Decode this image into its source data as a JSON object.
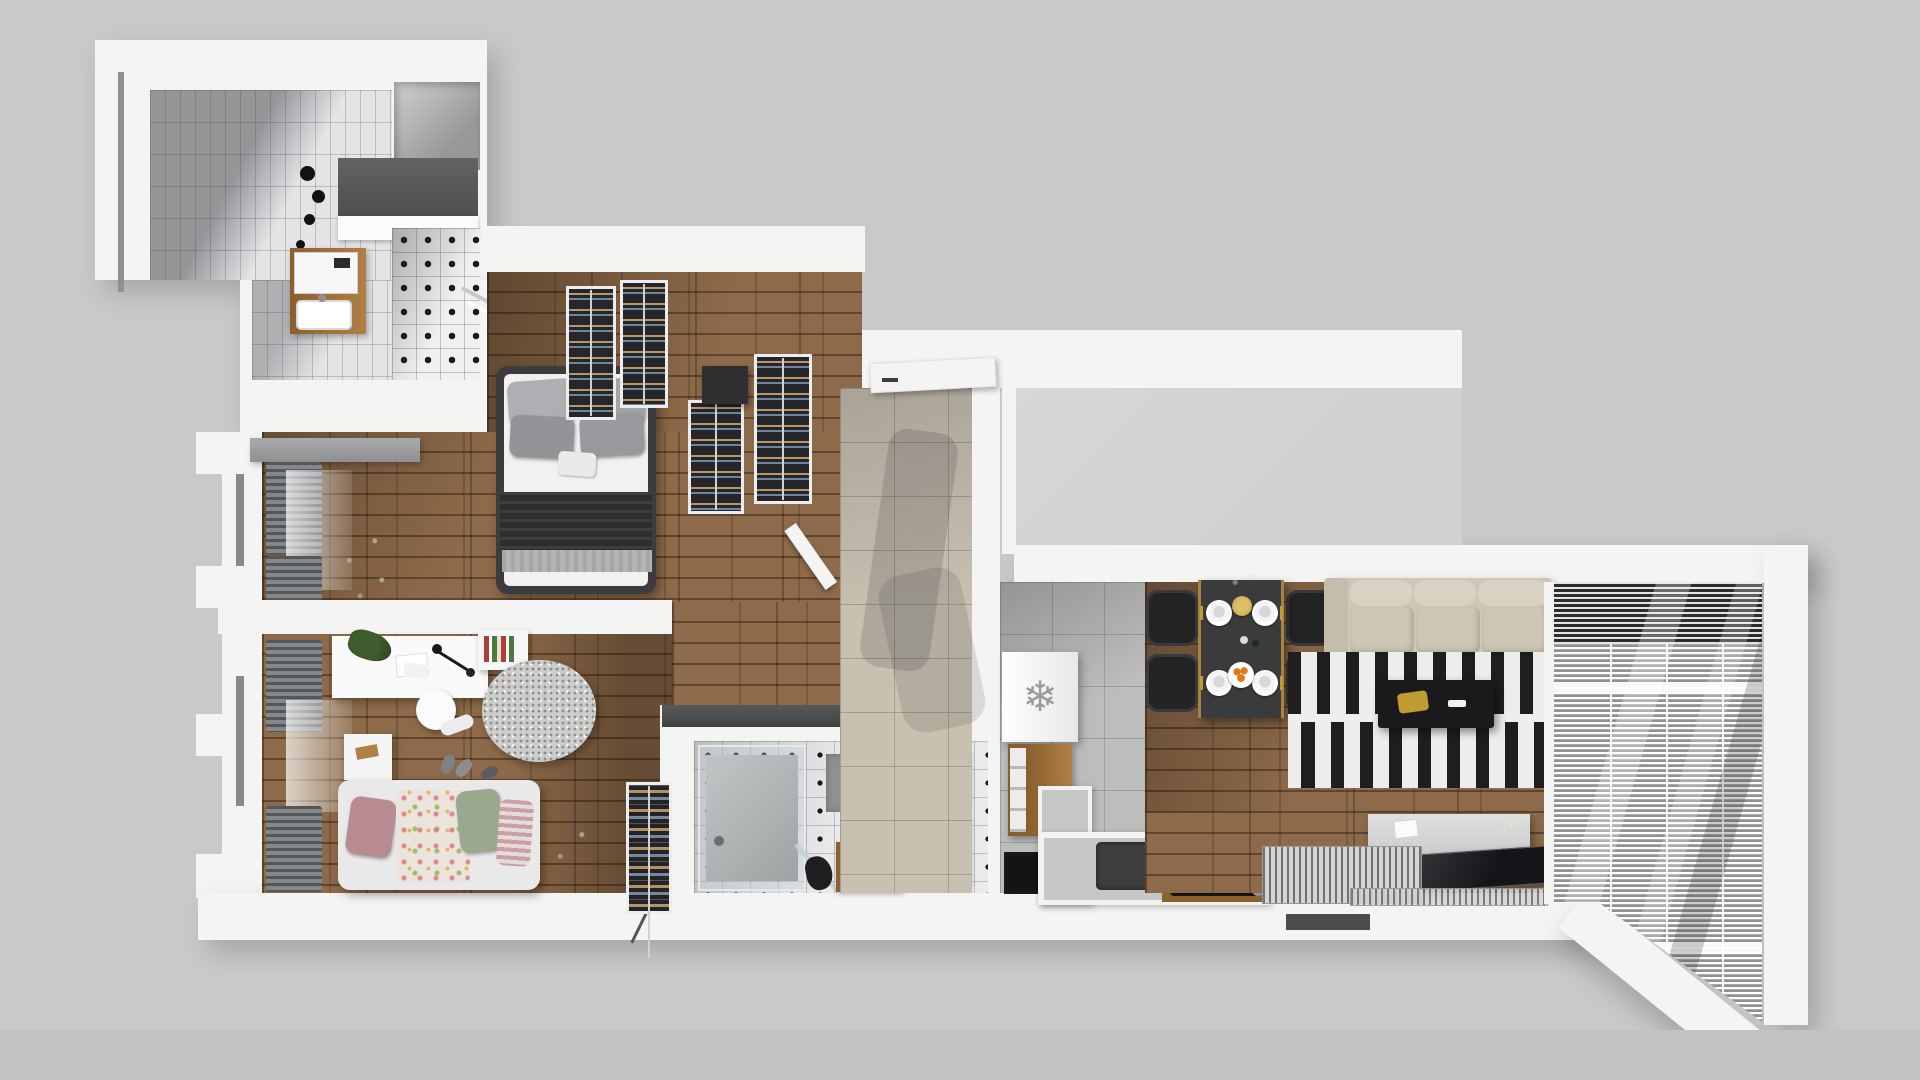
{
  "scene": {
    "kind": "apartment-floor-plan-3d-render",
    "view": "top-down"
  },
  "colors": {
    "bg": "#c9c9ca",
    "bg_bottom": "#c2c2c3",
    "wall": "#f4f4f2",
    "wall_block": "#d0d1d3",
    "wood_base": "#7a5a3c",
    "wood_row": "#8d6a49",
    "wood_gap": "#5f452e",
    "tile_beige": "#c8c1b2",
    "tile_gray": "#bdbdbe",
    "tile_bath": "#eaeaec",
    "accent_black": "#17181a",
    "rug_stripe": "#1e1e20",
    "sofa": "#cec7b6",
    "sofa_back": "#d9d2c2",
    "sofa_arm": "#c4bdac",
    "curtain": "#54565a",
    "plant": "#33502a",
    "plant_light": "#5d7f45",
    "wood_furn": "#b08046",
    "wood_furn_dark": "#8a5f2e",
    "balcony_dark": "#2d2d2f",
    "counter_gray": "#c5c7c7",
    "hob_black": "#141416",
    "freezer_icon_color": "#9b9b9d",
    "kid_pink": "#b88a92",
    "kid_green": "#9aa88e",
    "kid_stripe": "#c9a0a4",
    "gold": "#c09a33",
    "orange": "#e07818"
  },
  "icons": {
    "freezer_snowflake": "❄"
  }
}
